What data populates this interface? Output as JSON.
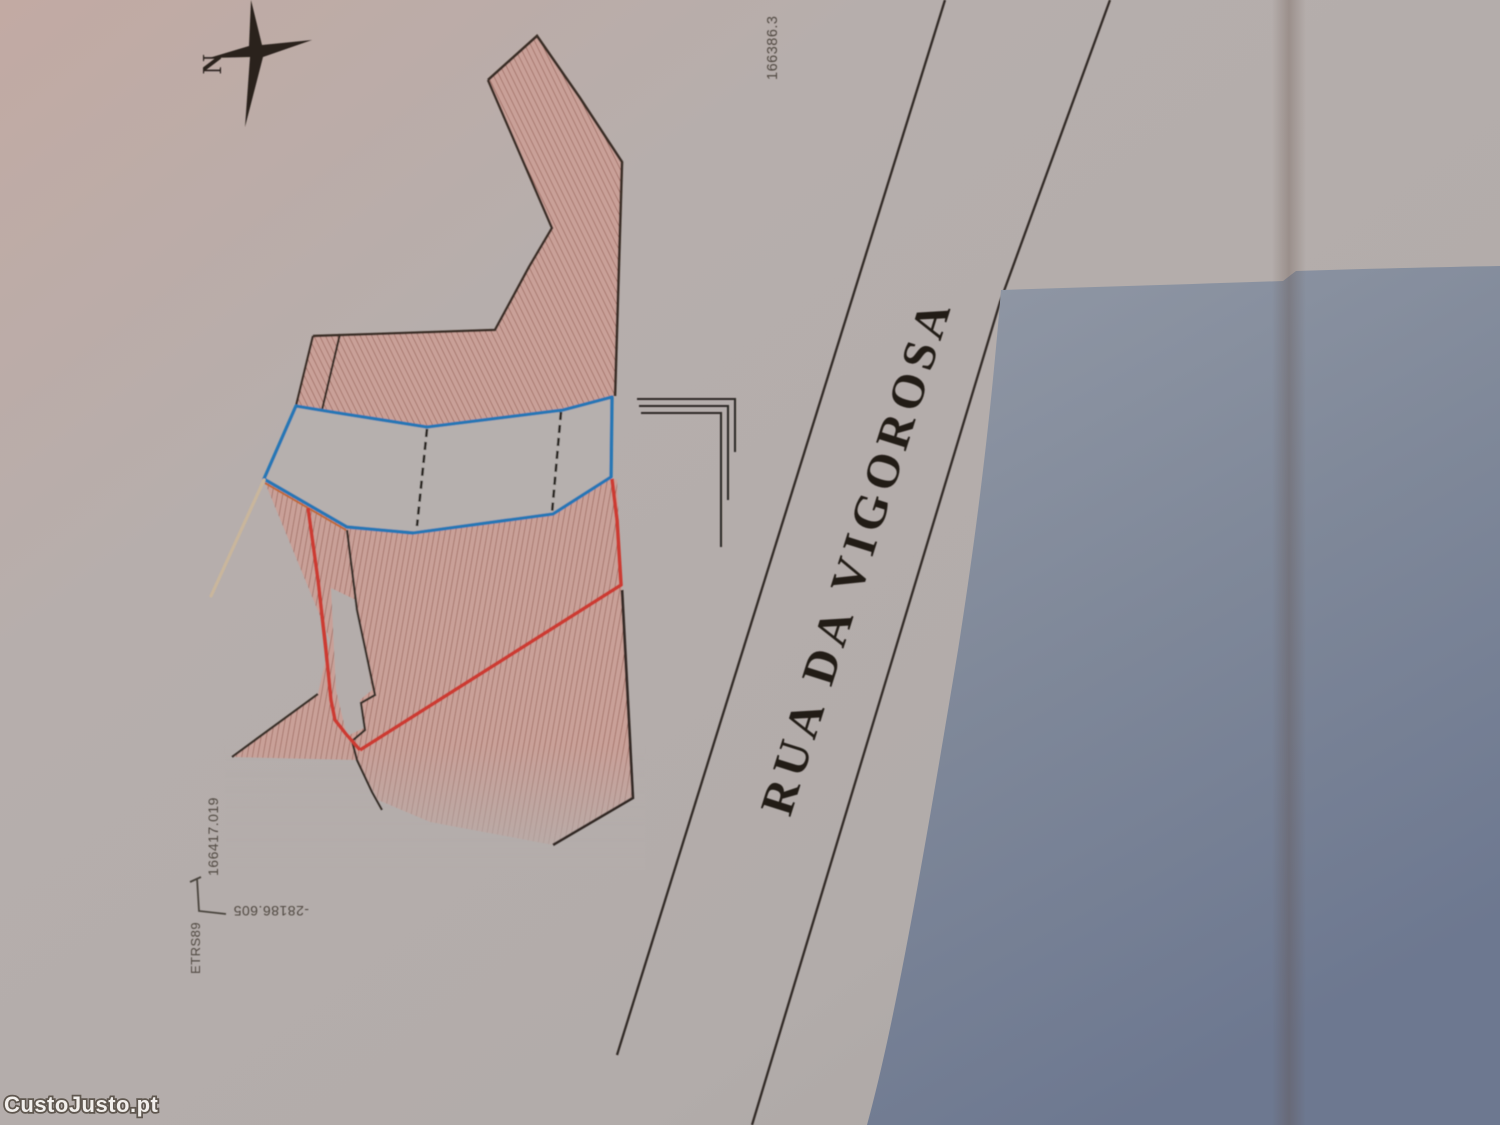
{
  "map": {
    "street_label": "RUA DA VIGOROSA",
    "compass": {
      "north_label": "N"
    },
    "coordinates": {
      "datum_label": "ETRS89",
      "top_right_value": "166386.3",
      "left_axis_value": "166417.019",
      "bottom_axis_value": "-28186.605"
    },
    "watermark": "CustoJusto.pt",
    "colors": {
      "paper": "#b4adab",
      "hatch_line": "#8f5a50",
      "hatch_fill": "#c79e95",
      "parcel_outline_blue": "#2677b5",
      "boundary_red": "#cc3a31",
      "boundary_orange": "#c06a38",
      "ink_black": "#352c26",
      "background_dark": "#7c8598",
      "tan_line": "#c9b69c"
    }
  }
}
